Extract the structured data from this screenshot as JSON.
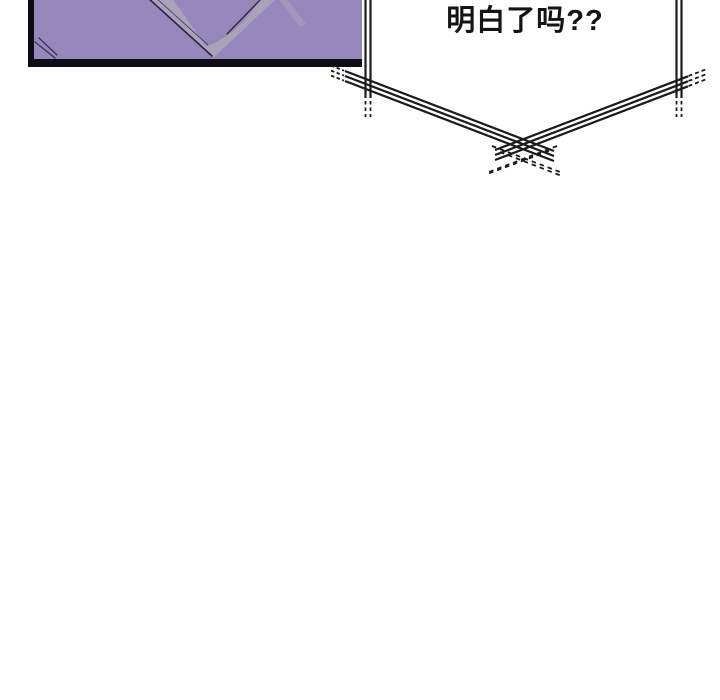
{
  "page": {
    "kind": "webtoon-comic-page"
  },
  "panel": {
    "artwork": "purple v-neck collar close-up"
  },
  "speech_bubble": {
    "text": "明白了吗??"
  },
  "colors": {
    "page_bg": "#ffffff",
    "panel_fill": "#9687bd",
    "panel_border": "#0d0b13",
    "collar_band": "#a9a2bc",
    "collar_shadow": "#8f88a6",
    "art_line": "#2b2443",
    "bubble_fill": "#ffffff",
    "bubble_line": "#1b1b1b",
    "text_color": "#141414"
  }
}
